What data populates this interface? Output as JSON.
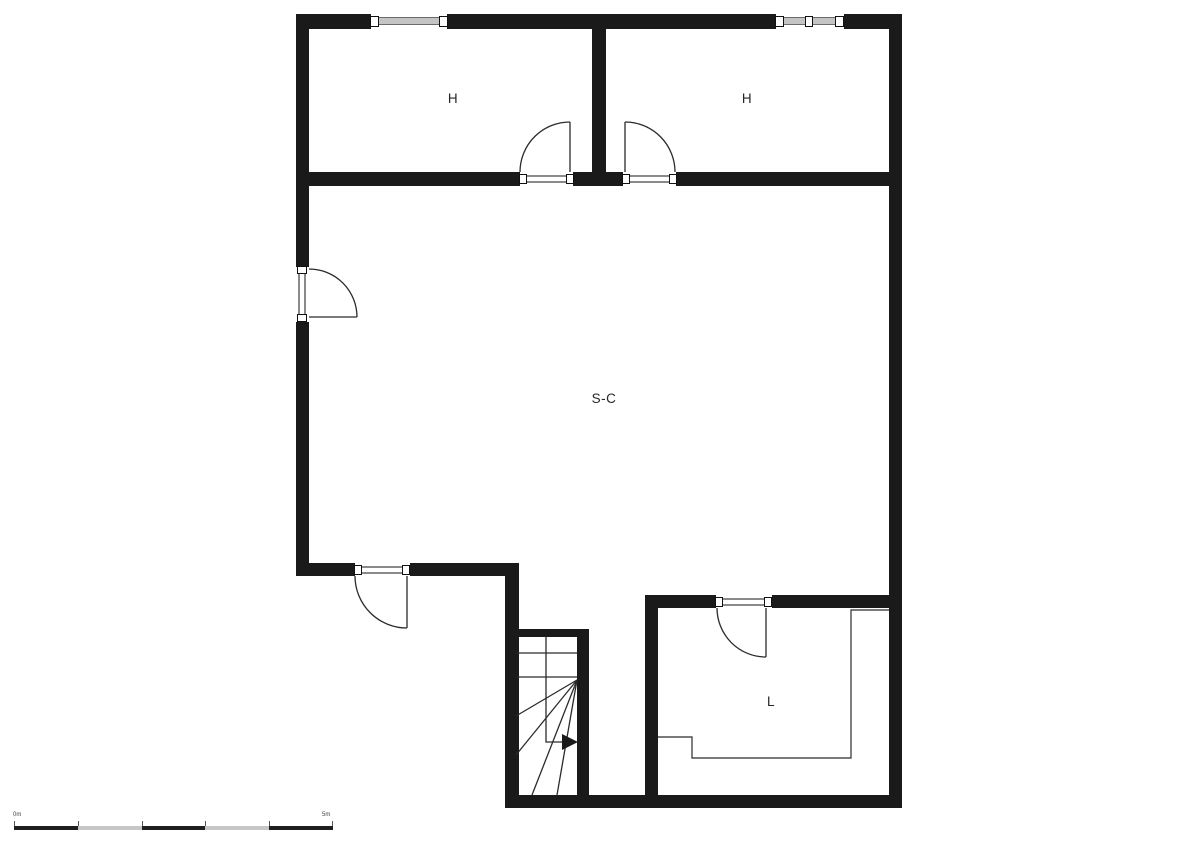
{
  "plan": {
    "rooms": [
      {
        "id": "hall-left",
        "label": "H"
      },
      {
        "id": "hall-right",
        "label": "H"
      },
      {
        "id": "living-area",
        "label": "S-C"
      },
      {
        "id": "room-l",
        "label": "L"
      }
    ],
    "scale_bar": {
      "start_label": "0m",
      "end_label": "5m"
    },
    "colors": {
      "wall": "#1a1a1a",
      "window_frame": "#8a8a8a",
      "thin_line": "#2b2b2b",
      "background": "#ffffff"
    }
  }
}
